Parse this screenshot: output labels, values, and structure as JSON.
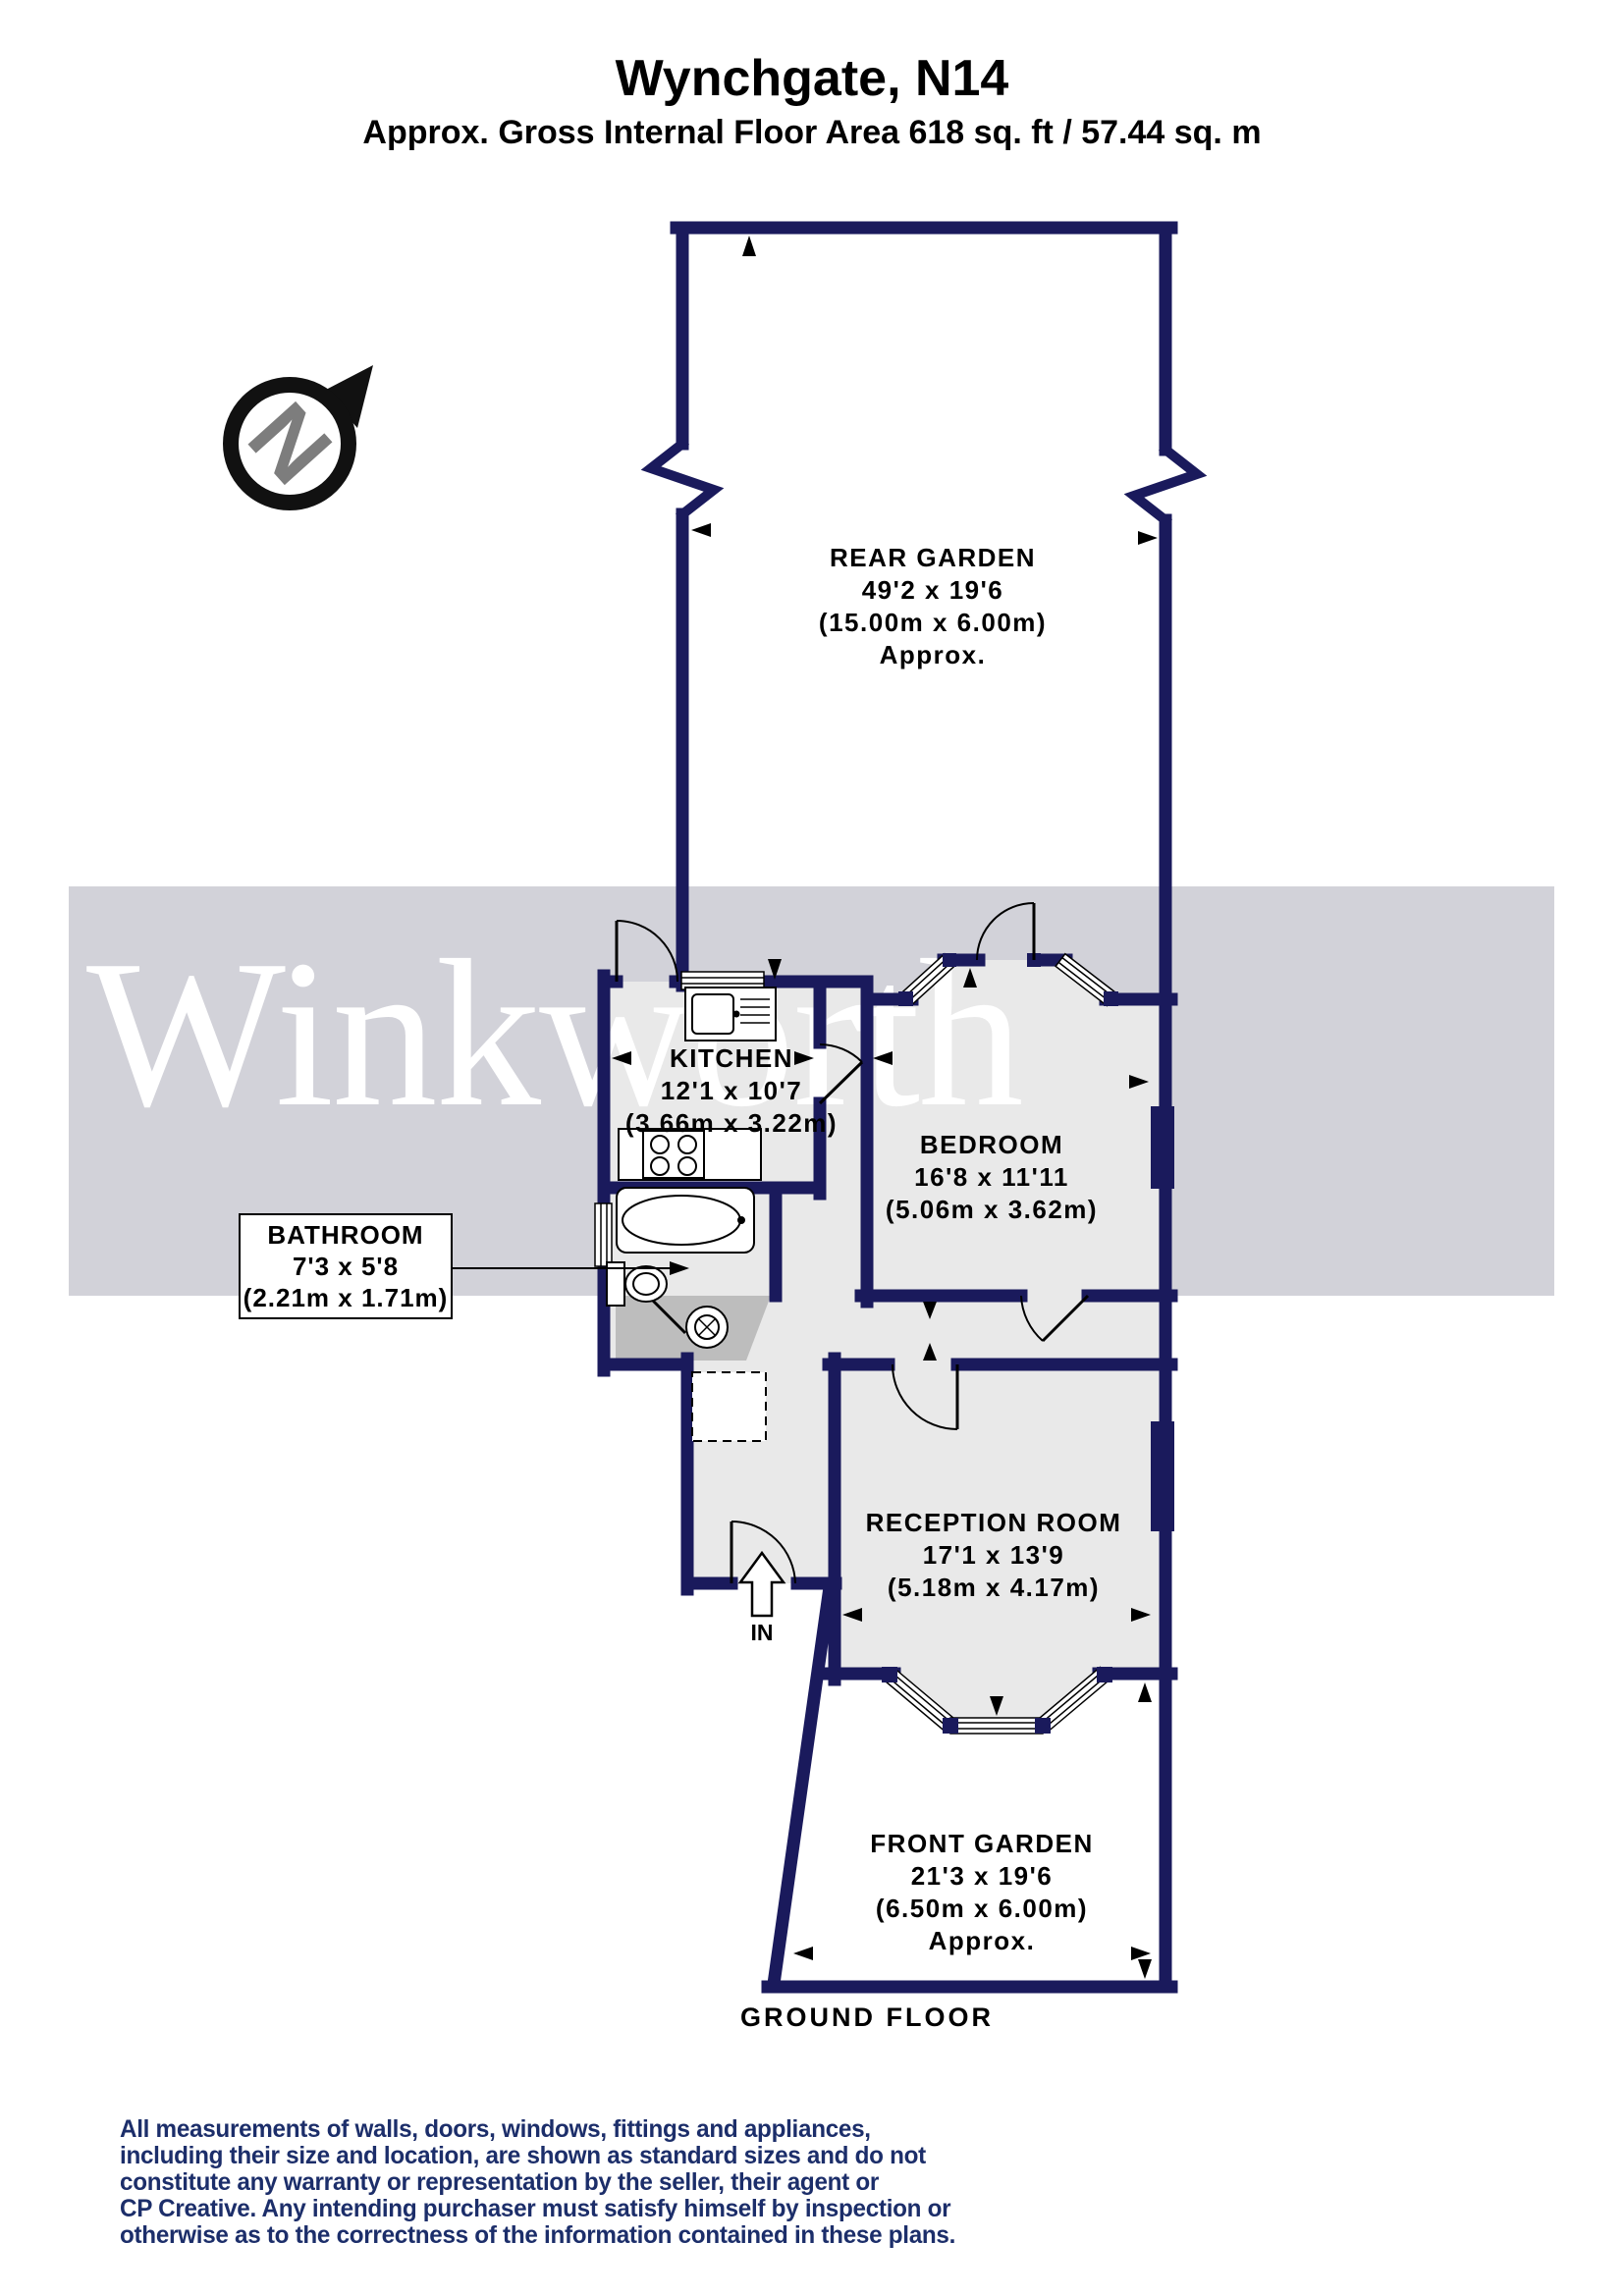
{
  "header": {
    "title": "Wynchgate, N14",
    "subtitle": "Approx. Gross Internal Floor Area 618 sq. ft / 57.44 sq. m"
  },
  "compass": {
    "north_letter": "N"
  },
  "watermark": {
    "text": "Winkworth"
  },
  "rooms": {
    "rear_garden": {
      "name": "REAR GARDEN",
      "dims_ft": "49'2 x 19'6",
      "dims_m": "(15.00m x 6.00m)",
      "approx": "Approx."
    },
    "kitchen": {
      "name": "KITCHEN",
      "dims_ft": "12'1 x 10'7",
      "dims_m": "(3.66m x 3.22m)"
    },
    "bedroom": {
      "name": "BEDROOM",
      "dims_ft": "16'8 x 11'11",
      "dims_m": "(5.06m x 3.62m)"
    },
    "bathroom": {
      "name": "BATHROOM",
      "dims_ft": "7'3 x 5'8",
      "dims_m": "(2.21m x 1.71m)"
    },
    "reception_room": {
      "name": "RECEPTION ROOM",
      "dims_ft": "17'1 x 13'9",
      "dims_m": "(5.18m x 4.17m)"
    },
    "front_garden": {
      "name": "FRONT GARDEN",
      "dims_ft": "21'3 x 19'6",
      "dims_m": "(6.50m x 6.00m)",
      "approx": "Approx."
    }
  },
  "plan_labels": {
    "floor": "GROUND FLOOR",
    "entrance": "IN"
  },
  "disclaimer": {
    "lines": [
      "All measurements of walls, doors, windows, fittings and appliances,",
      "including their size and location, are shown as standard sizes and do not",
      "constitute any warranty or representation by the seller, their agent or",
      "CP Creative. Any intending purchaser must satisfy himself by inspection or",
      "otherwise as to the correctness of the information contained in these plans."
    ]
  },
  "colors": {
    "wall_navy": "#1a1a5c",
    "room_fill": "#e9e9e9",
    "watermark_band": "#d2d2d9",
    "lobby_gray": "#bdbdbd",
    "disclaimer_text": "#1c2e6a"
  }
}
